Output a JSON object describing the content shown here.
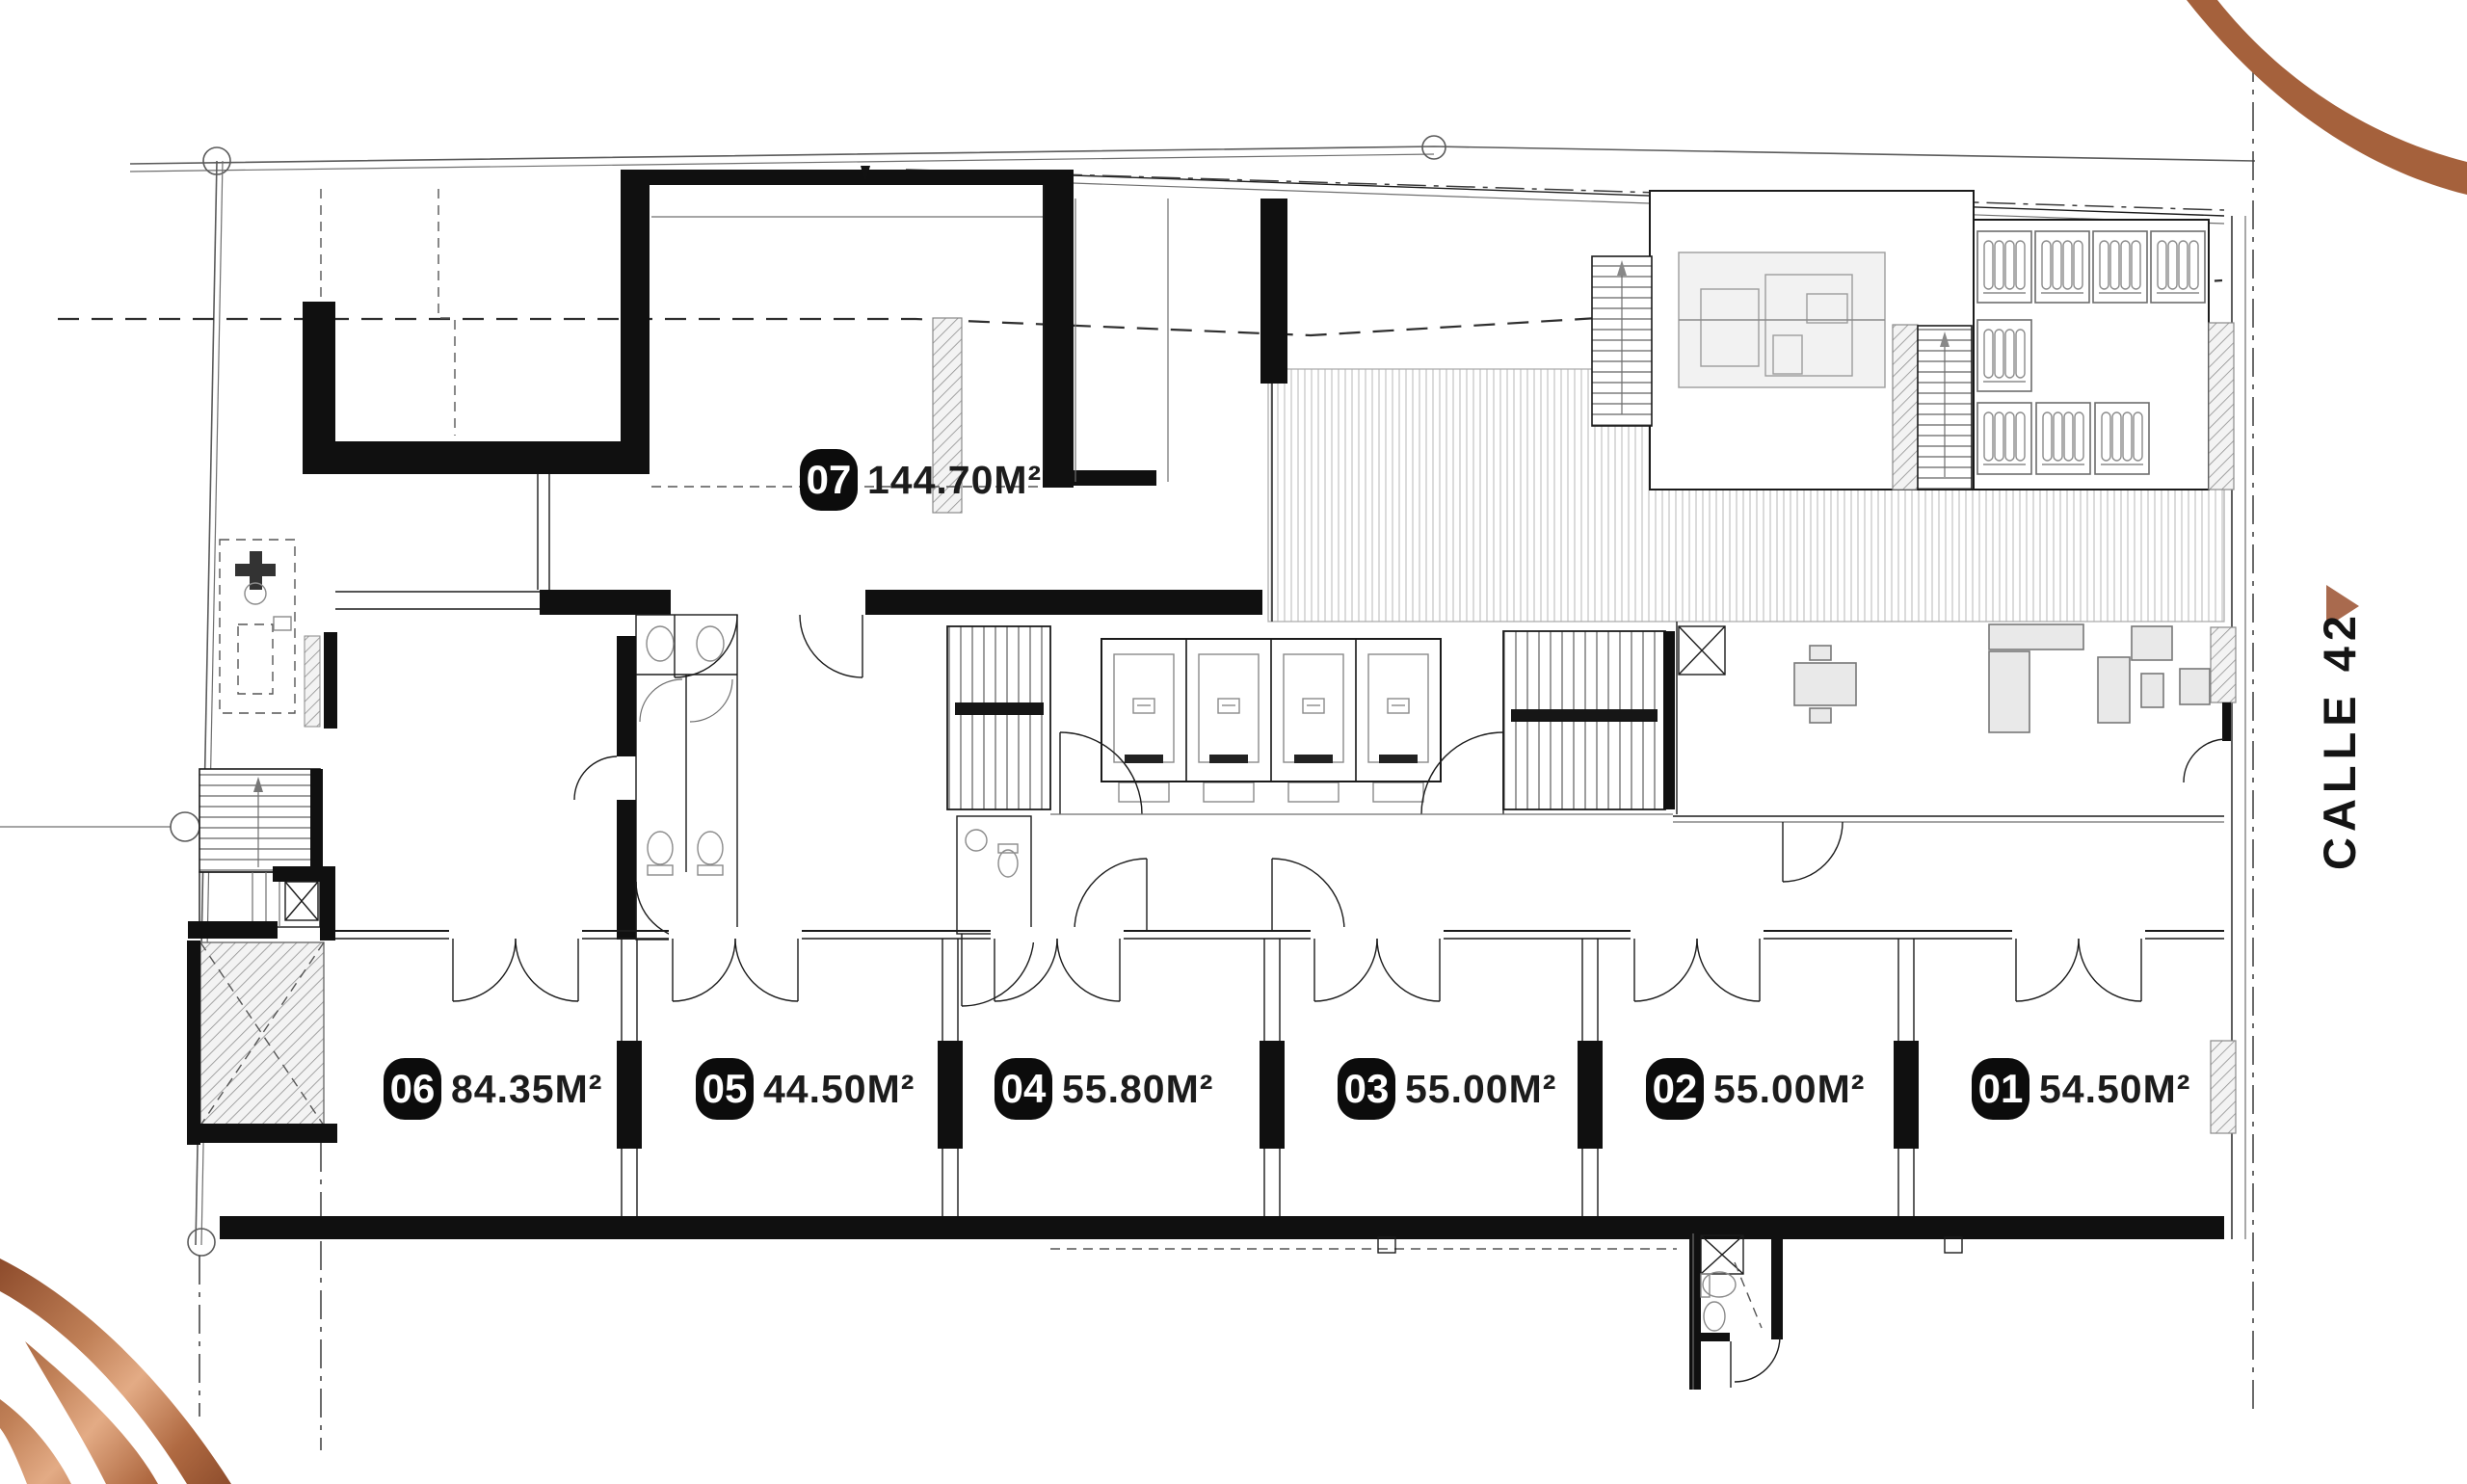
{
  "units": [
    {
      "id": "07",
      "area": "144.70M²"
    },
    {
      "id": "06",
      "area": "84.35M²"
    },
    {
      "id": "05",
      "area": "44.50M²"
    },
    {
      "id": "04",
      "area": "55.80M²"
    },
    {
      "id": "03",
      "area": "55.00M²"
    },
    {
      "id": "02",
      "area": "55.00M²"
    },
    {
      "id": "01",
      "area": "54.50M²"
    }
  ],
  "street": {
    "name": "CALLE 42"
  },
  "colors": {
    "copper": "#A5613C",
    "copper_light": "#E3AB85",
    "copper_dark": "#8E4C2C",
    "ink": "#111111"
  }
}
